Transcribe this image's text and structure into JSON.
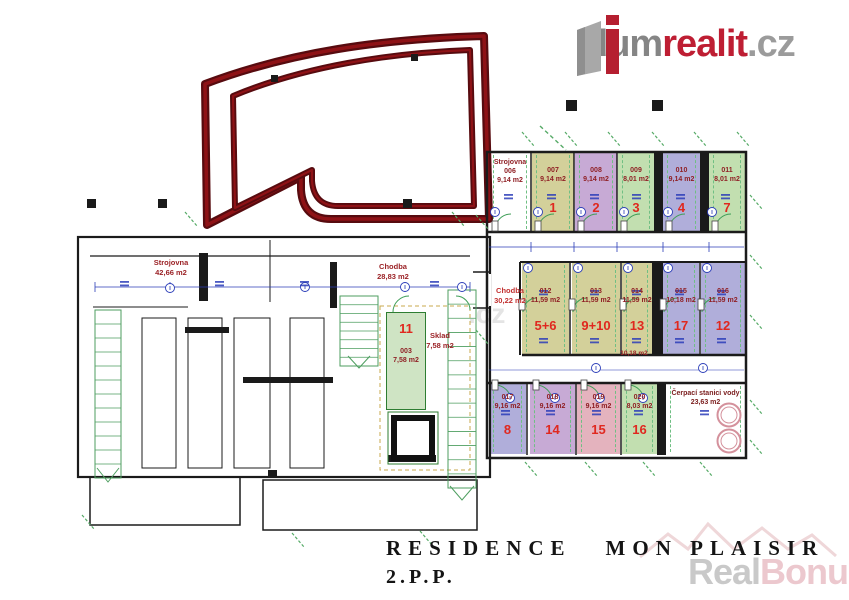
{
  "brand": {
    "dum": "dum",
    "realit": "realit",
    "cz": ".cz",
    "icon": "dumrealit-building-logo"
  },
  "title": {
    "line1": "RESIDENCE",
    "line2": "MON PLAISIR",
    "floor": "2.P.P."
  },
  "watermark": {
    "real": "Real",
    "bonus": "Bonus",
    "cz": ".cz",
    "center": ".cz"
  },
  "plan": {
    "strojovna_label": "Strojovna",
    "strojovna_area": "42,66 m2",
    "chodba_label": "Chodba",
    "chodba_area": "28,83 m2",
    "room11": {
      "num": "11",
      "code": "003",
      "area": "7,58 m2"
    },
    "sklad_label": "Sklad",
    "sklad_area": "7,58 m2"
  },
  "grid": {
    "corridor_left": {
      "label": "Chodba",
      "area": "30,22 m2"
    },
    "corridor_mid_area": "10,18 m2",
    "pump": {
      "label": "Čerpací stanici vody",
      "area": "23,63 m2"
    },
    "row1": [
      {
        "name": "Strojovna",
        "code": "006",
        "area": "9,14 m2",
        "num": "",
        "color": "white"
      },
      {
        "code": "007",
        "area": "9,14 m2",
        "num": "1",
        "color": "olive"
      },
      {
        "code": "008",
        "area": "9,14 m2",
        "num": "2",
        "color": "violet"
      },
      {
        "code": "009",
        "area": "8,01 m2",
        "num": "3",
        "color": "green"
      },
      {
        "code": "010",
        "area": "9,14 m2",
        "num": "4",
        "color": "blue"
      },
      {
        "code": "011",
        "area": "8,01 m2",
        "num": "7",
        "color": "green"
      }
    ],
    "row2": [
      {
        "code": "012",
        "area": "11,59 m2",
        "num": "5+6",
        "color": "olive"
      },
      {
        "code": "013",
        "area": "11,59 m2",
        "num": "9+10",
        "color": "olive"
      },
      {
        "code": "014",
        "area": "11,59 m2",
        "num": "13",
        "color": "olive"
      },
      {
        "code": "015",
        "area": "10,18 m2",
        "num": "17",
        "color": "blue"
      },
      {
        "code": "016",
        "area": "11,59 m2",
        "num": "12",
        "color": "blue"
      }
    ],
    "row3": [
      {
        "code": "017",
        "area": "9,16 m2",
        "num": "8",
        "color": "blue"
      },
      {
        "code": "018",
        "area": "9,16 m2",
        "num": "14",
        "color": "violet"
      },
      {
        "code": "019",
        "area": "9,16 m2",
        "num": "15",
        "color": "pink"
      },
      {
        "code": "020",
        "area": "8,03 m2",
        "num": "16",
        "color": "green"
      }
    ]
  },
  "colors": {
    "accent_red": "#be1e33",
    "ramp_maroon": "#570b0f",
    "cell_olive": "#d3d09a",
    "cell_violet": "#c7aad5",
    "cell_green": "#c2dfb0",
    "cell_blue": "#b0aeda",
    "cell_pink": "#e4b3be",
    "dim_blue": "#2b3db8",
    "hatch_green": "#4d9e5f",
    "label_dark_red": "#8f1f24",
    "number_red": "#e0281f"
  }
}
